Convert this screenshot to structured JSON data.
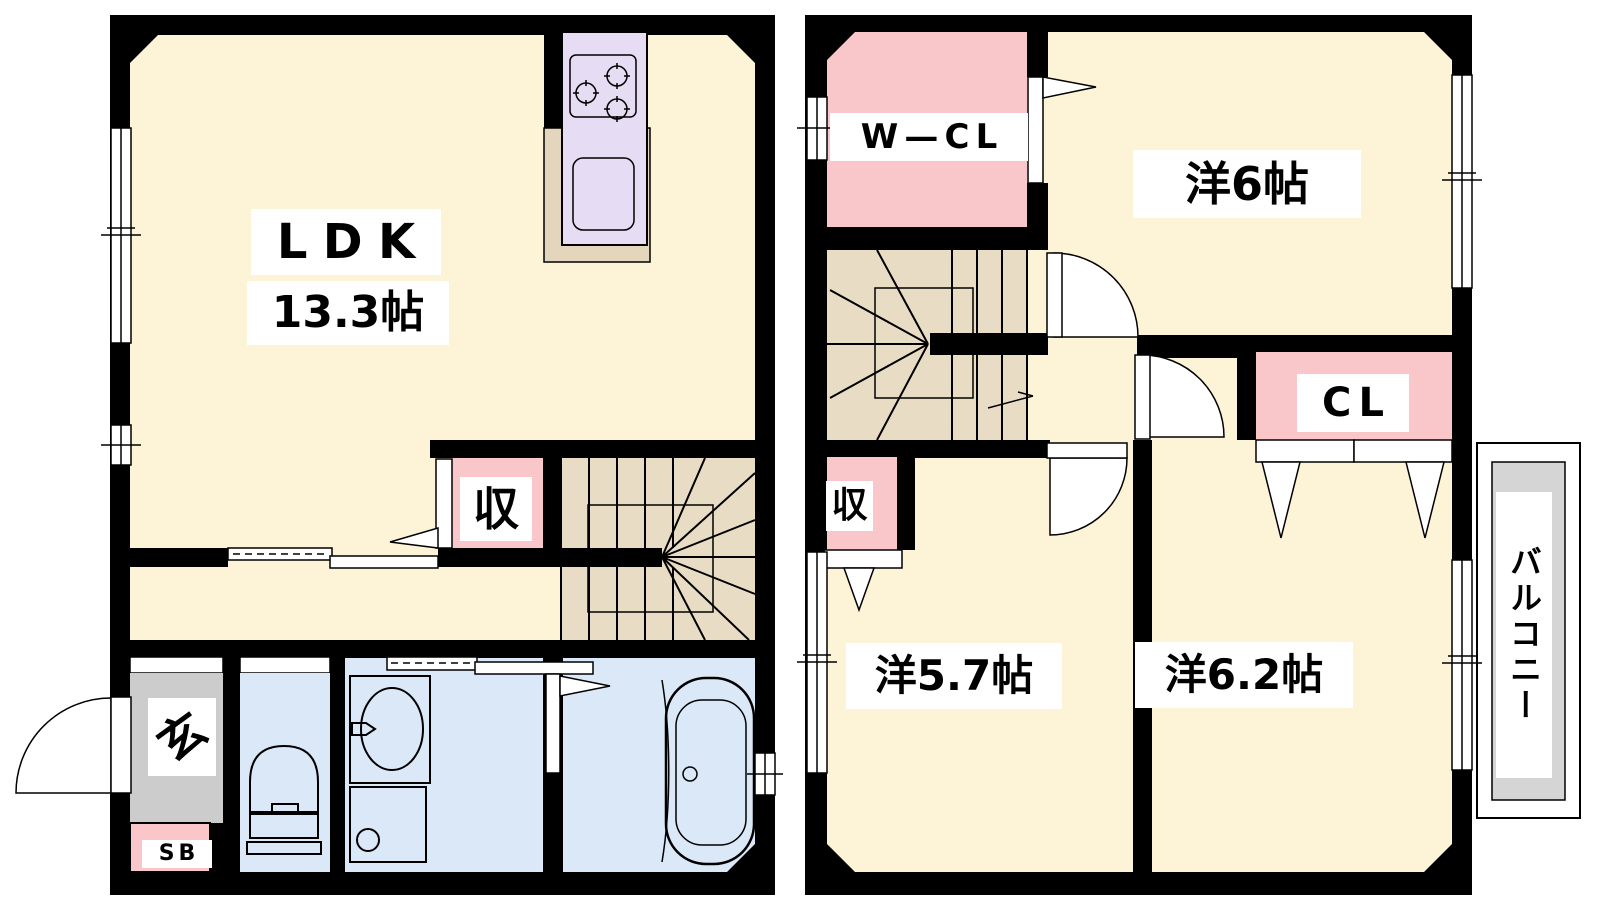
{
  "floor1": {
    "ldk_label": "LDK",
    "ldk_size": "13.3帖",
    "storage_label": "収",
    "entrance_label": "玄",
    "shoebox_label": "SB"
  },
  "floor2": {
    "walkin_closet_label": "W—CL",
    "room6_label": "洋6帖",
    "closet_label": "CL",
    "storage_label": "収",
    "room57_label": "洋5.7帖",
    "room62_label": "洋6.2帖",
    "balcony_label": "バルコニー"
  },
  "colors": {
    "wall": "#000000",
    "floor": "#fdf3d7",
    "stairs": "#e9dcc4",
    "counter": "#e3d6bc",
    "kitchen": "#e6dcf3",
    "pink": "#f9c7ca",
    "blue": "#dbe8f8",
    "gray": "#cccccc",
    "balcony": "#d5d5d5"
  }
}
